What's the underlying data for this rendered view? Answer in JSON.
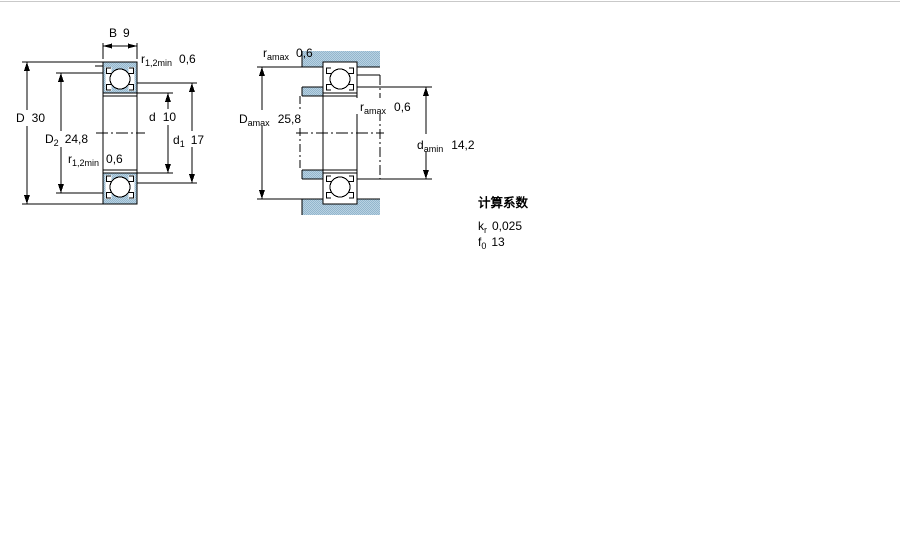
{
  "drawing": {
    "left_figure": {
      "width_B": {
        "base": "B",
        "value": "9"
      },
      "chamfer_top": {
        "base": "r",
        "sub": "1,2min",
        "value": "0,6"
      },
      "outer_diameter_D": {
        "base": "D",
        "value": "30"
      },
      "recess_diameter_D2": {
        "base": "D",
        "sub": "2",
        "value": "24,8"
      },
      "chamfer_mid": {
        "base": "r",
        "sub": "1,2min",
        "value": "0,6"
      },
      "bore_diameter_d": {
        "base": "d",
        "value": "10"
      },
      "shoulder_diameter_d1": {
        "base": "d",
        "sub": "1",
        "value": "17"
      }
    },
    "right_figure": {
      "housing_fillet": {
        "base": "r",
        "sub": "amax",
        "value": "0,6"
      },
      "housing_abutment_Da": {
        "base": "D",
        "sub": "amax",
        "value": "25,8"
      },
      "shaft_fillet": {
        "base": "r",
        "sub": "amax",
        "value": "0,6"
      },
      "shaft_abutment_da": {
        "base": "d",
        "sub": "amin",
        "value": "14,2"
      }
    }
  },
  "calculation_factors": {
    "title": "计算系数",
    "rows": [
      {
        "base": "k",
        "sub": "r",
        "value": "0,025"
      },
      {
        "base": "f",
        "sub": "0",
        "value": "13"
      }
    ]
  },
  "colors": {
    "section_fill_light": "#b9d2e2",
    "section_fill_dark": "#93b6cd",
    "line": "#000000",
    "top_border": "#c9c9c9"
  }
}
